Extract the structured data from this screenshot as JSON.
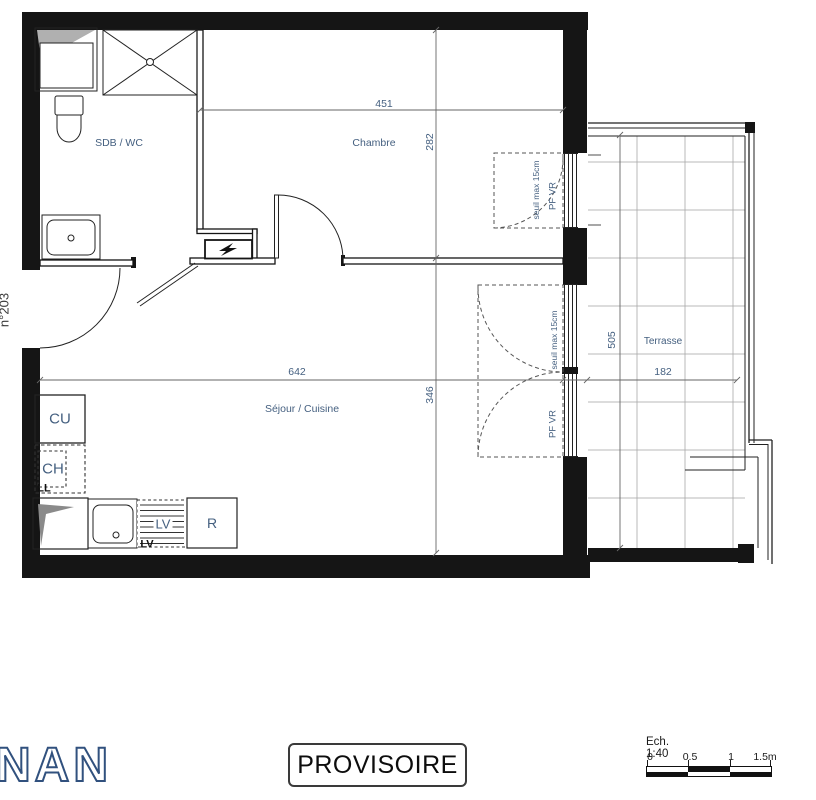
{
  "apartment_number": "n°203",
  "rooms": {
    "bathroom": "SDB / WC",
    "bedroom": "Chambre",
    "living": "Séjour / Cuisine",
    "terrace": "Terrasse"
  },
  "dimensions": {
    "bedroom_width": "451",
    "bedroom_depth": "282",
    "living_width": "642",
    "living_depth": "346",
    "terrace_depth": "505",
    "terrace_width": "182"
  },
  "windows": {
    "bedroom": {
      "threshold": "seuil max 15cm",
      "label": "PF VR"
    },
    "living": {
      "threshold": "seuil max 15cm",
      "label": "PF VR"
    }
  },
  "appliances": {
    "hob": "CU",
    "water_heater": "CH",
    "washer": "LL",
    "dishwasher": "LV",
    "dishwasher_mark": "LV",
    "fridge": "R"
  },
  "stamp": "PROVISOIRE",
  "logo_text": "NAN",
  "scale_bar": {
    "label": "Ech. 1:40",
    "ticks": [
      "0",
      "0.5",
      "1",
      "1.5m"
    ]
  },
  "colors": {
    "label_blue": "#456080",
    "wall_black": "#151515",
    "logo_blue": "#31517e"
  }
}
